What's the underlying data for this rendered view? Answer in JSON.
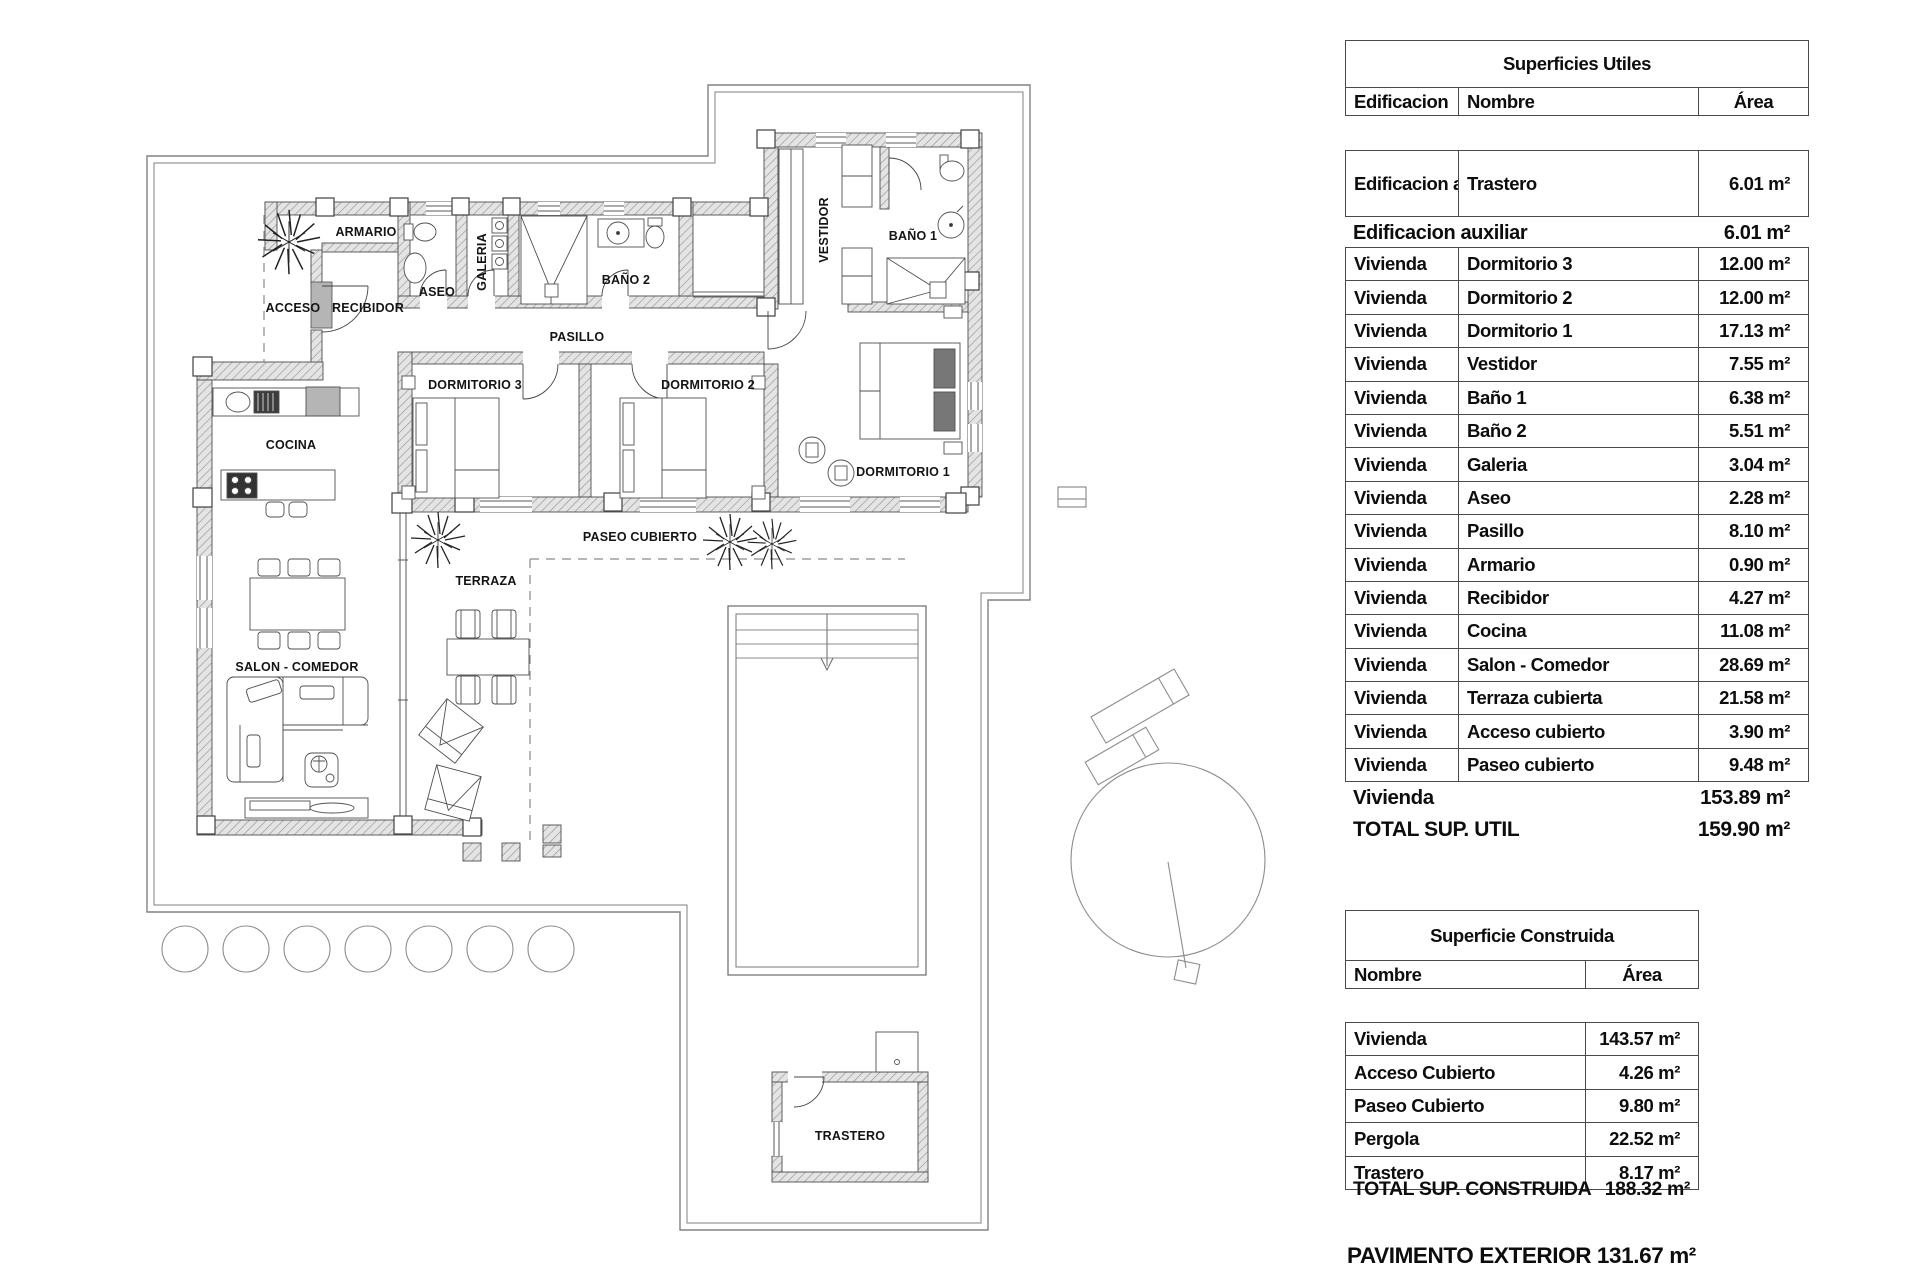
{
  "plan": {
    "labels": {
      "armario": "ARMARIO",
      "acceso": "ACCESO",
      "recibidor": "RECIBIDOR",
      "aseo": "ASEO",
      "galeria": "GALERIA",
      "bano2": "BAÑO 2",
      "pasillo": "PASILLO",
      "dormitorio3": "DORMITORIO 3",
      "dormitorio2": "DORMITORIO 2",
      "dormitorio1": "DORMITORIO 1",
      "vestidor": "VESTIDOR",
      "bano1": "BAÑO 1",
      "cocina": "COCINA",
      "salon": "SALON - COMEDOR",
      "terraza": "TERRAZA",
      "paseo": "PASEO CUBIERTO",
      "trastero": "TRASTERO"
    }
  },
  "tables": {
    "utiles": {
      "title": "Superficies Utiles",
      "columns": [
        "Edificacion",
        "Nombre",
        "Área"
      ],
      "aux_row": {
        "edificacion": "Edificacion auxiliar",
        "nombre": "Trastero",
        "area": "6.01 m²"
      },
      "aux_summary": {
        "label": "Edificacion auxiliar",
        "area": "6.01 m²"
      },
      "rows": [
        [
          "Vivienda",
          "Dormitorio 3",
          "12.00 m²"
        ],
        [
          "Vivienda",
          "Dormitorio 2",
          "12.00 m²"
        ],
        [
          "Vivienda",
          "Dormitorio 1",
          "17.13 m²"
        ],
        [
          "Vivienda",
          "Vestidor",
          "7.55 m²"
        ],
        [
          "Vivienda",
          "Baño 1",
          "6.38 m²"
        ],
        [
          "Vivienda",
          "Baño 2",
          "5.51 m²"
        ],
        [
          "Vivienda",
          "Galeria",
          "3.04 m²"
        ],
        [
          "Vivienda",
          "Aseo",
          "2.28 m²"
        ],
        [
          "Vivienda",
          "Pasillo",
          "8.10 m²"
        ],
        [
          "Vivienda",
          "Armario",
          "0.90 m²"
        ],
        [
          "Vivienda",
          "Recibidor",
          "4.27 m²"
        ],
        [
          "Vivienda",
          "Cocina",
          "11.08 m²"
        ],
        [
          "Vivienda",
          "Salon - Comedor",
          "28.69 m²"
        ],
        [
          "Vivienda",
          "Terraza cubierta",
          "21.58 m²"
        ],
        [
          "Vivienda",
          "Acceso cubierto",
          "3.90 m²"
        ],
        [
          "Vivienda",
          "Paseo cubierto",
          "9.48 m²"
        ]
      ],
      "summaries": [
        {
          "label": "Vivienda",
          "area": "153.89 m²"
        },
        {
          "label": "TOTAL SUP. UTIL",
          "area": "159.90 m²"
        }
      ]
    },
    "construida": {
      "title": "Superficie Construida",
      "columns": [
        "Nombre",
        "Área"
      ],
      "rows": [
        [
          "Vivienda",
          "143.57 m²"
        ],
        [
          "Acceso Cubierto",
          "4.26 m²"
        ],
        [
          "Paseo Cubierto",
          "9.80 m²"
        ],
        [
          "Pergola",
          "22.52 m²"
        ],
        [
          "Trastero",
          "8.17 m²"
        ]
      ],
      "total": {
        "label": "TOTAL SUP. CONSTRUIDA",
        "area": "188.32 m²"
      }
    },
    "pavimento": "PAVIMENTO EXTERIOR 131.67 m²"
  }
}
